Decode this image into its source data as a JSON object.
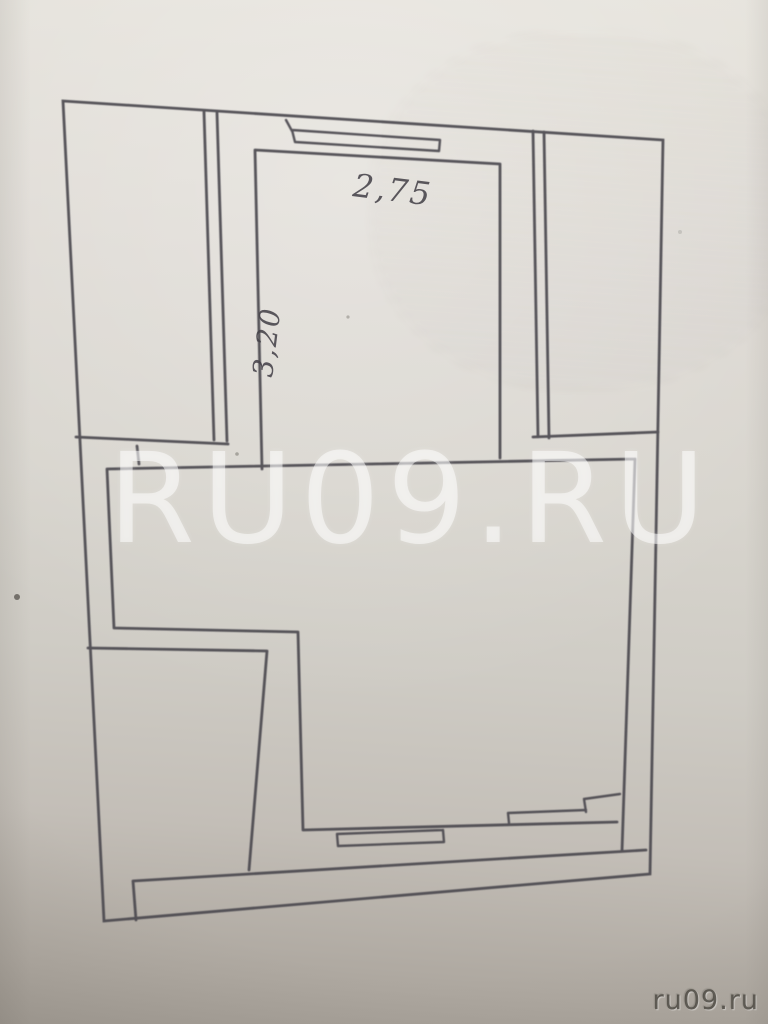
{
  "photo": {
    "watermark_text": "RU09.RU",
    "credit_text": "ru09.ru"
  },
  "floor_plan": {
    "dimension_top": "2,75",
    "dimension_left": "3,20",
    "ink_color": "#4b4850",
    "paper_color": "#d8d5cf"
  }
}
